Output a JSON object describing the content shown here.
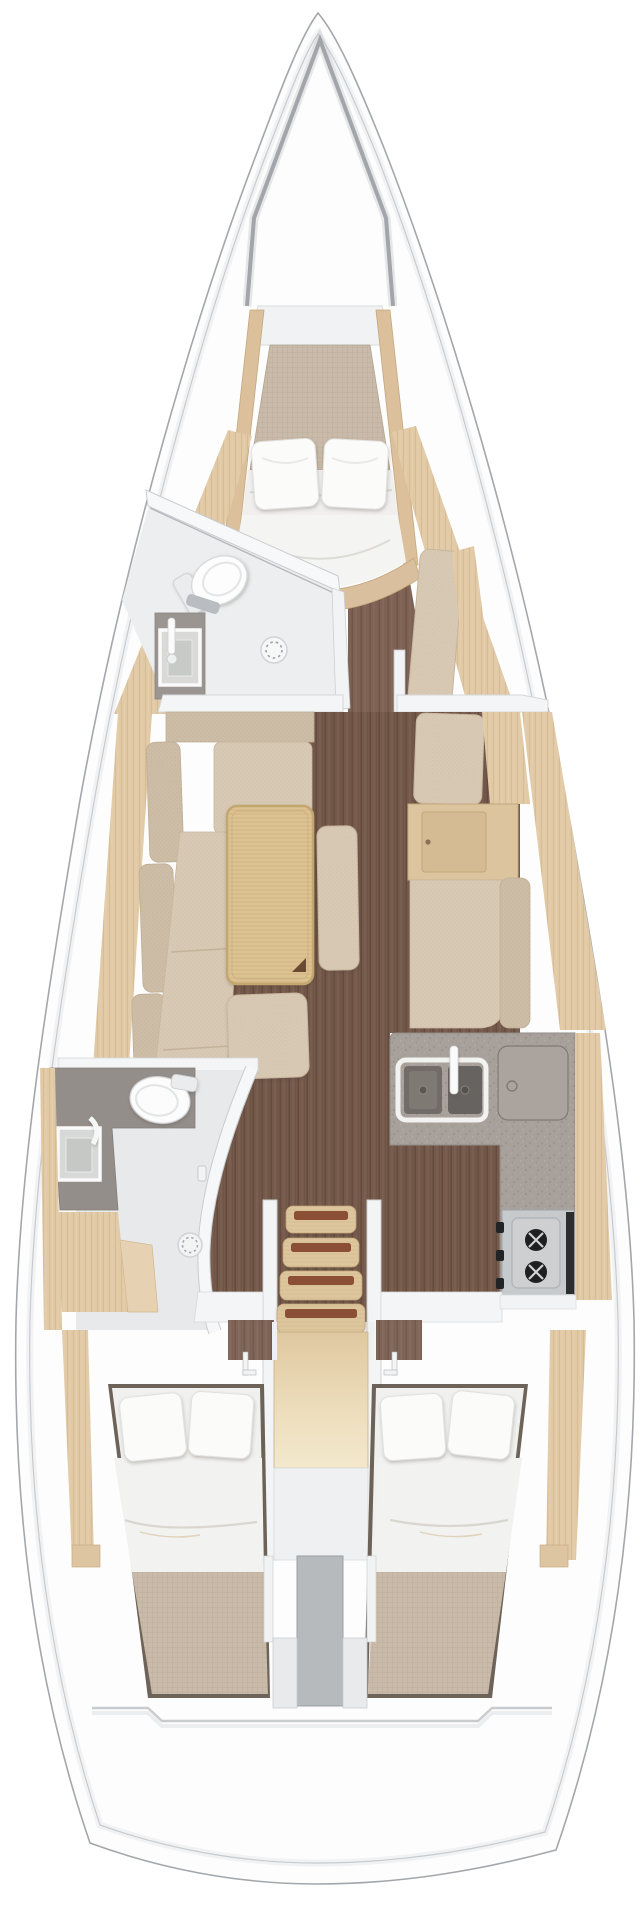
{
  "document": {
    "kind": "sailing-yacht interior floor plan, top-down 3D cutaway",
    "orientation": "bow-up",
    "visible_text": "none"
  },
  "palette": {
    "canvas": "#ffffff",
    "hull_outline": "#a3a7ab",
    "deck_inner_line": "#c7cbce",
    "wood_trim": "#e1c9a6",
    "walnut_floor": "#75594b",
    "upholstery": "#d8c9b4",
    "upholstery_back": "#cdbda6",
    "table_wood": "#dcc394",
    "mattress_linen": "#c9baa9",
    "bedding_white": "#f3f3f1",
    "counter_gray": "#a8a19b",
    "fixture_white": "#f5f6f7",
    "stove_steel": "#c7cacc",
    "burner_black": "#1e1f20"
  },
  "rooms": {
    "bow": {
      "label": "Bow / anchor locker"
    },
    "owner_cabin": {
      "label": "Forward owner cabin with island V-berth and two pillows"
    },
    "forward_head": {
      "label": "Forward head: toilet, sink unit and shower drain"
    },
    "saloon": {
      "label": "Saloon: port L-sofa, folding table, bench and ottoman"
    },
    "nav_seat": {
      "label": "Starboard seat and locker cabinet"
    },
    "chaise": {
      "label": "Starboard chaise seat"
    },
    "galley": {
      "label": "L-shaped galley: double sink, worktop lid, two-burner gimbal stove"
    },
    "aft_head": {
      "label": "Aft head: toilet, sink, shower compartment with curved door"
    },
    "companionway": {
      "label": "Companionway ladder with four non-slip treads over engine box"
    },
    "port_aft_cabin": {
      "label": "Port aft double cabin"
    },
    "starboard_aft_cabin": {
      "label": "Starboard aft double cabin"
    },
    "stern": {
      "label": "Stern / transom platform"
    }
  },
  "fixtures": {
    "fwd_pillows": 2,
    "port_aft_pillows": 2,
    "stbd_aft_pillows": 2,
    "sink_basins_galley": 2,
    "stove_burners": 2,
    "stair_treads": 4,
    "toilets": 2,
    "shower_drains": 2
  }
}
